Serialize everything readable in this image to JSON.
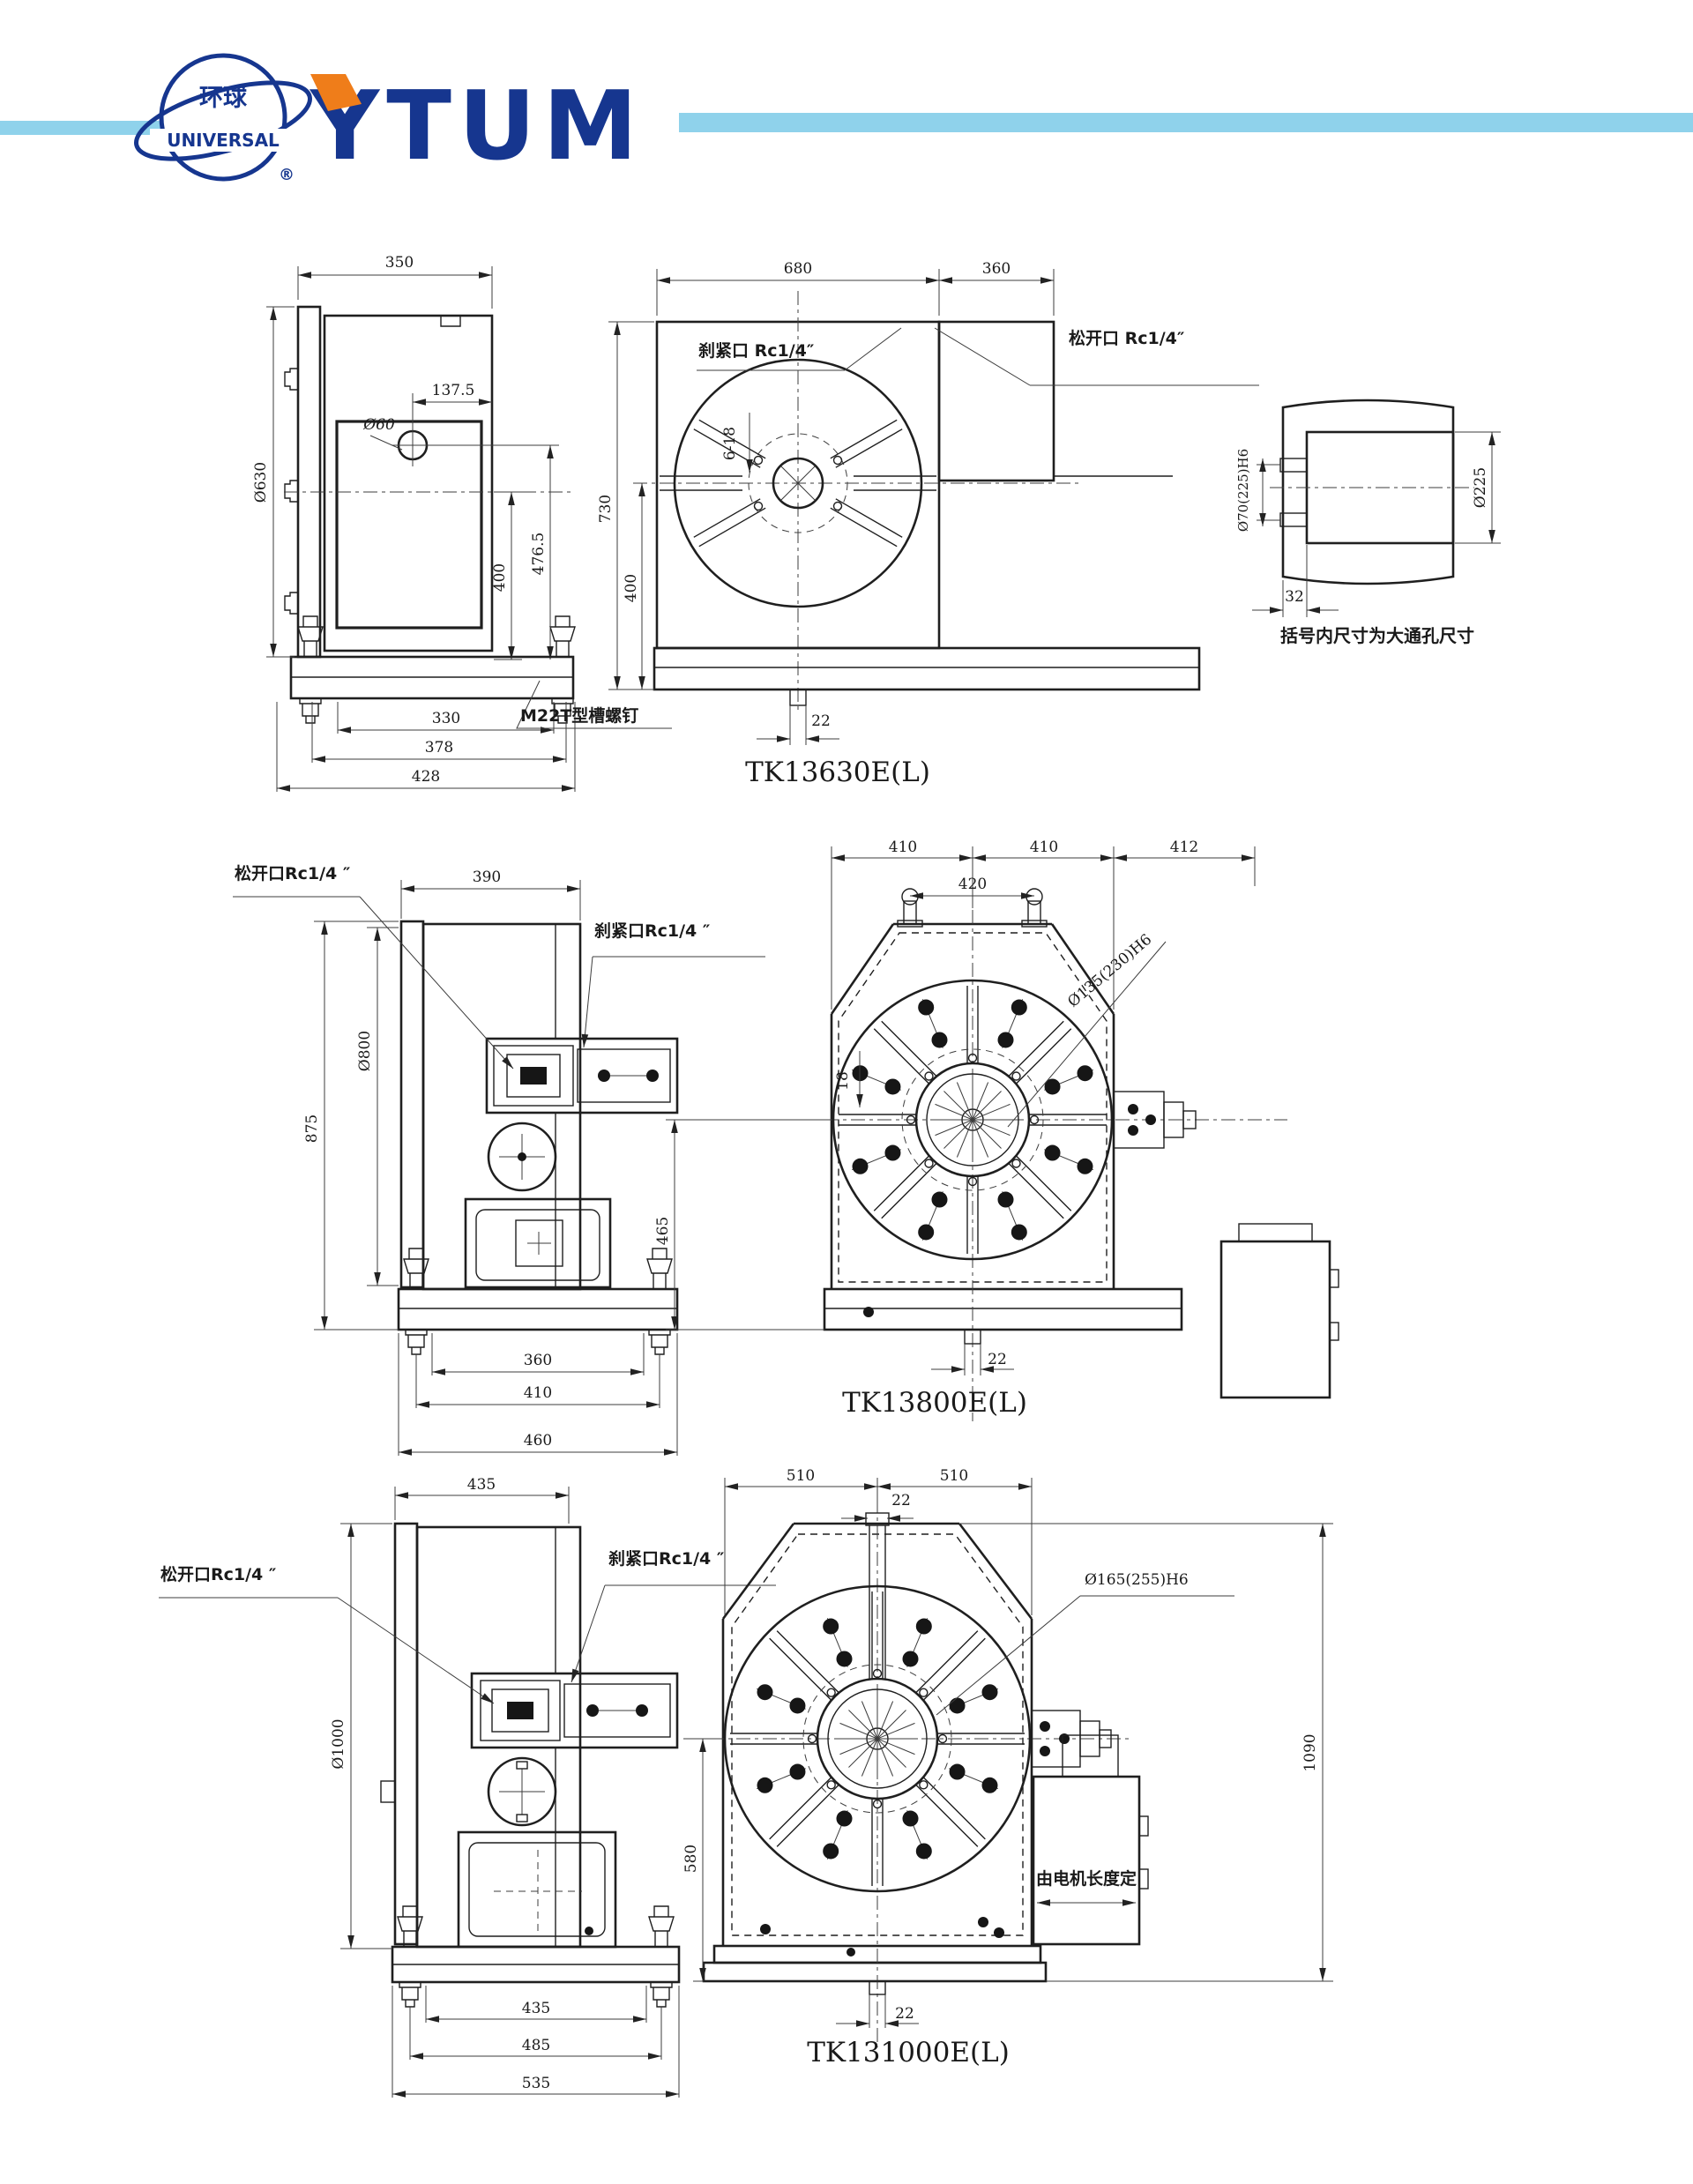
{
  "header": {
    "logo_cn": "环球",
    "logo_en": "UNIVERSAL",
    "logo_reg": "®",
    "brand": "YTUM",
    "accent_blue": "#16368f",
    "accent_orange": "#ef7d1a",
    "bar_color": "#8fd2eb"
  },
  "d1": {
    "title": "TK13630E(L)",
    "side": {
      "w": "350",
      "dia": "Ø630",
      "off": "137.5",
      "hole": "Ø60",
      "h1": "400",
      "h2": "476.5",
      "b1": "330",
      "b2": "378",
      "b3": "428",
      "callout": "M22T型槽螺钉"
    },
    "front": {
      "w1": "680",
      "w2": "360",
      "h1": "730",
      "h2": "400",
      "clamp": "刹紧口 Rc1/4″",
      "release": "松开口 Rc1/4″",
      "slots": "6-18",
      "key": "22"
    },
    "shaft": {
      "bore": "Ø70(225)H6",
      "spigot": "Ø225",
      "depth": "32",
      "note": "括号内尺寸为大通孔尺寸"
    }
  },
  "d2": {
    "title": "TK13800E(L)",
    "side": {
      "w": "390",
      "h": "875",
      "dia": "Ø800",
      "release": "松开口Rc1/4 ″",
      "clamp": "刹紧口Rc1/4 ″",
      "b1": "360",
      "b2": "410",
      "b3": "460"
    },
    "front": {
      "t1": "410",
      "t2": "410",
      "t3": "412",
      "inner": "420",
      "bore": "Ø135(230)H6",
      "slot": "18",
      "h": "465",
      "key": "22"
    }
  },
  "d3": {
    "title": "TK131000E(L)",
    "side": {
      "w": "435",
      "dia": "Ø1000",
      "release": "松开口Rc1/4 ″",
      "clamp": "刹紧口Rc1/4 ″",
      "b1": "435",
      "b2": "485",
      "b3": "535"
    },
    "front": {
      "t1": "510",
      "t2": "510",
      "key_top": "22",
      "bore": "Ø165(255)H6",
      "h": "580",
      "right": "1090",
      "motor": "由电机长度定",
      "key": "22"
    }
  }
}
